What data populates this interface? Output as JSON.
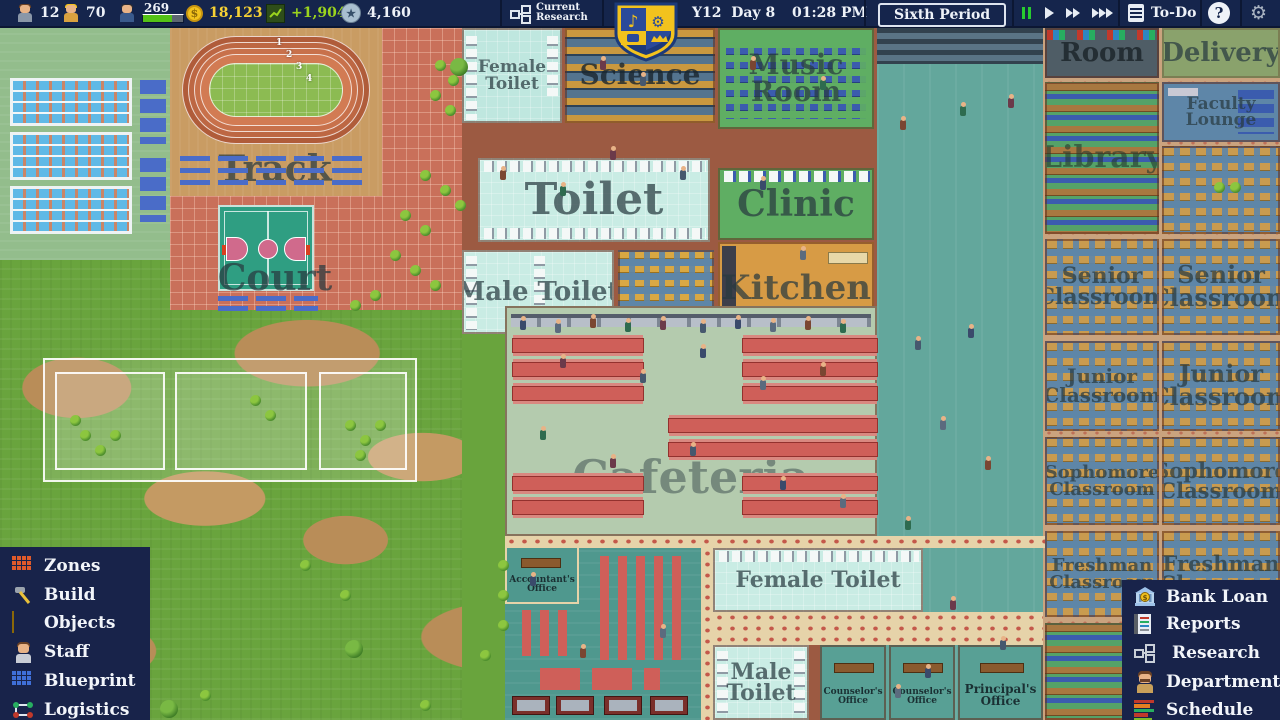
{
  "topbar": {
    "admin_count": "12",
    "workers_count": "70",
    "students_count": "269",
    "money": "18,123",
    "money_change": "+1,904",
    "points": "4,160",
    "research_line1": "Current",
    "research_line2": "Research",
    "date": "Y12  Day 8",
    "time": "01:28 PM",
    "period": "Sixth Period",
    "todo_label": "To-Do",
    "help_label": "?",
    "gear_glyph": "⚙",
    "coin_glyph": "$",
    "star_glyph": "★"
  },
  "menus": {
    "left": [
      {
        "label": "Zones"
      },
      {
        "label": "Build"
      },
      {
        "label": "Objects"
      },
      {
        "label": "Staff"
      },
      {
        "label": "Blueprint"
      },
      {
        "label": "Logistics"
      }
    ],
    "right": [
      {
        "label": "Bank Loan"
      },
      {
        "label": "Reports"
      },
      {
        "label": "Research"
      },
      {
        "label": "Department"
      },
      {
        "label": "Schedule"
      }
    ]
  },
  "map": {
    "labels": {
      "track": "Track",
      "court": "Court",
      "female_toilet_top": "Female Toilet",
      "science": "Science",
      "music_room": "Music Room",
      "toilet": "Toilet",
      "clinic": "Clinic",
      "male_toilet_top": "Male Toilet",
      "kitchen": "Kitchen",
      "cafeteria": "Cafeteria",
      "accountants_office": "Accountant's Office",
      "female_toilet_bottom": "Female Toilet",
      "male_toilet_bottom": "Male Toilet",
      "counselors_office_1": "Counselor's Office",
      "counselors_office_2": "Counselor's Office",
      "principals_office": "Principal's Office",
      "art_room": "Room",
      "delivery": "Delivery",
      "library": "Library",
      "faculty_lounge": "Faculty Lounge",
      "senior_classroom_l": "Senior Classroom",
      "senior_classroom_r": "Senior Classroom",
      "junior_classroom_l": "Junior Classroom",
      "junior_classroom_r": "Junior Classroom",
      "sophomore_classroom_l": "Sophomore Classroom",
      "sophomore_classroom_r": "Sophomore Classroom",
      "freshman_classroom_l": "Freshman Classroom",
      "freshman_classroom_r": "Freshman Classroom"
    },
    "track_lanes": [
      "1",
      "2",
      "3",
      "4"
    ]
  },
  "colors": {
    "accent_gold": "#f7d234",
    "accent_lime": "#9bd41e",
    "topbar_bg": "#15254c",
    "menu_bg": "#18234a"
  }
}
